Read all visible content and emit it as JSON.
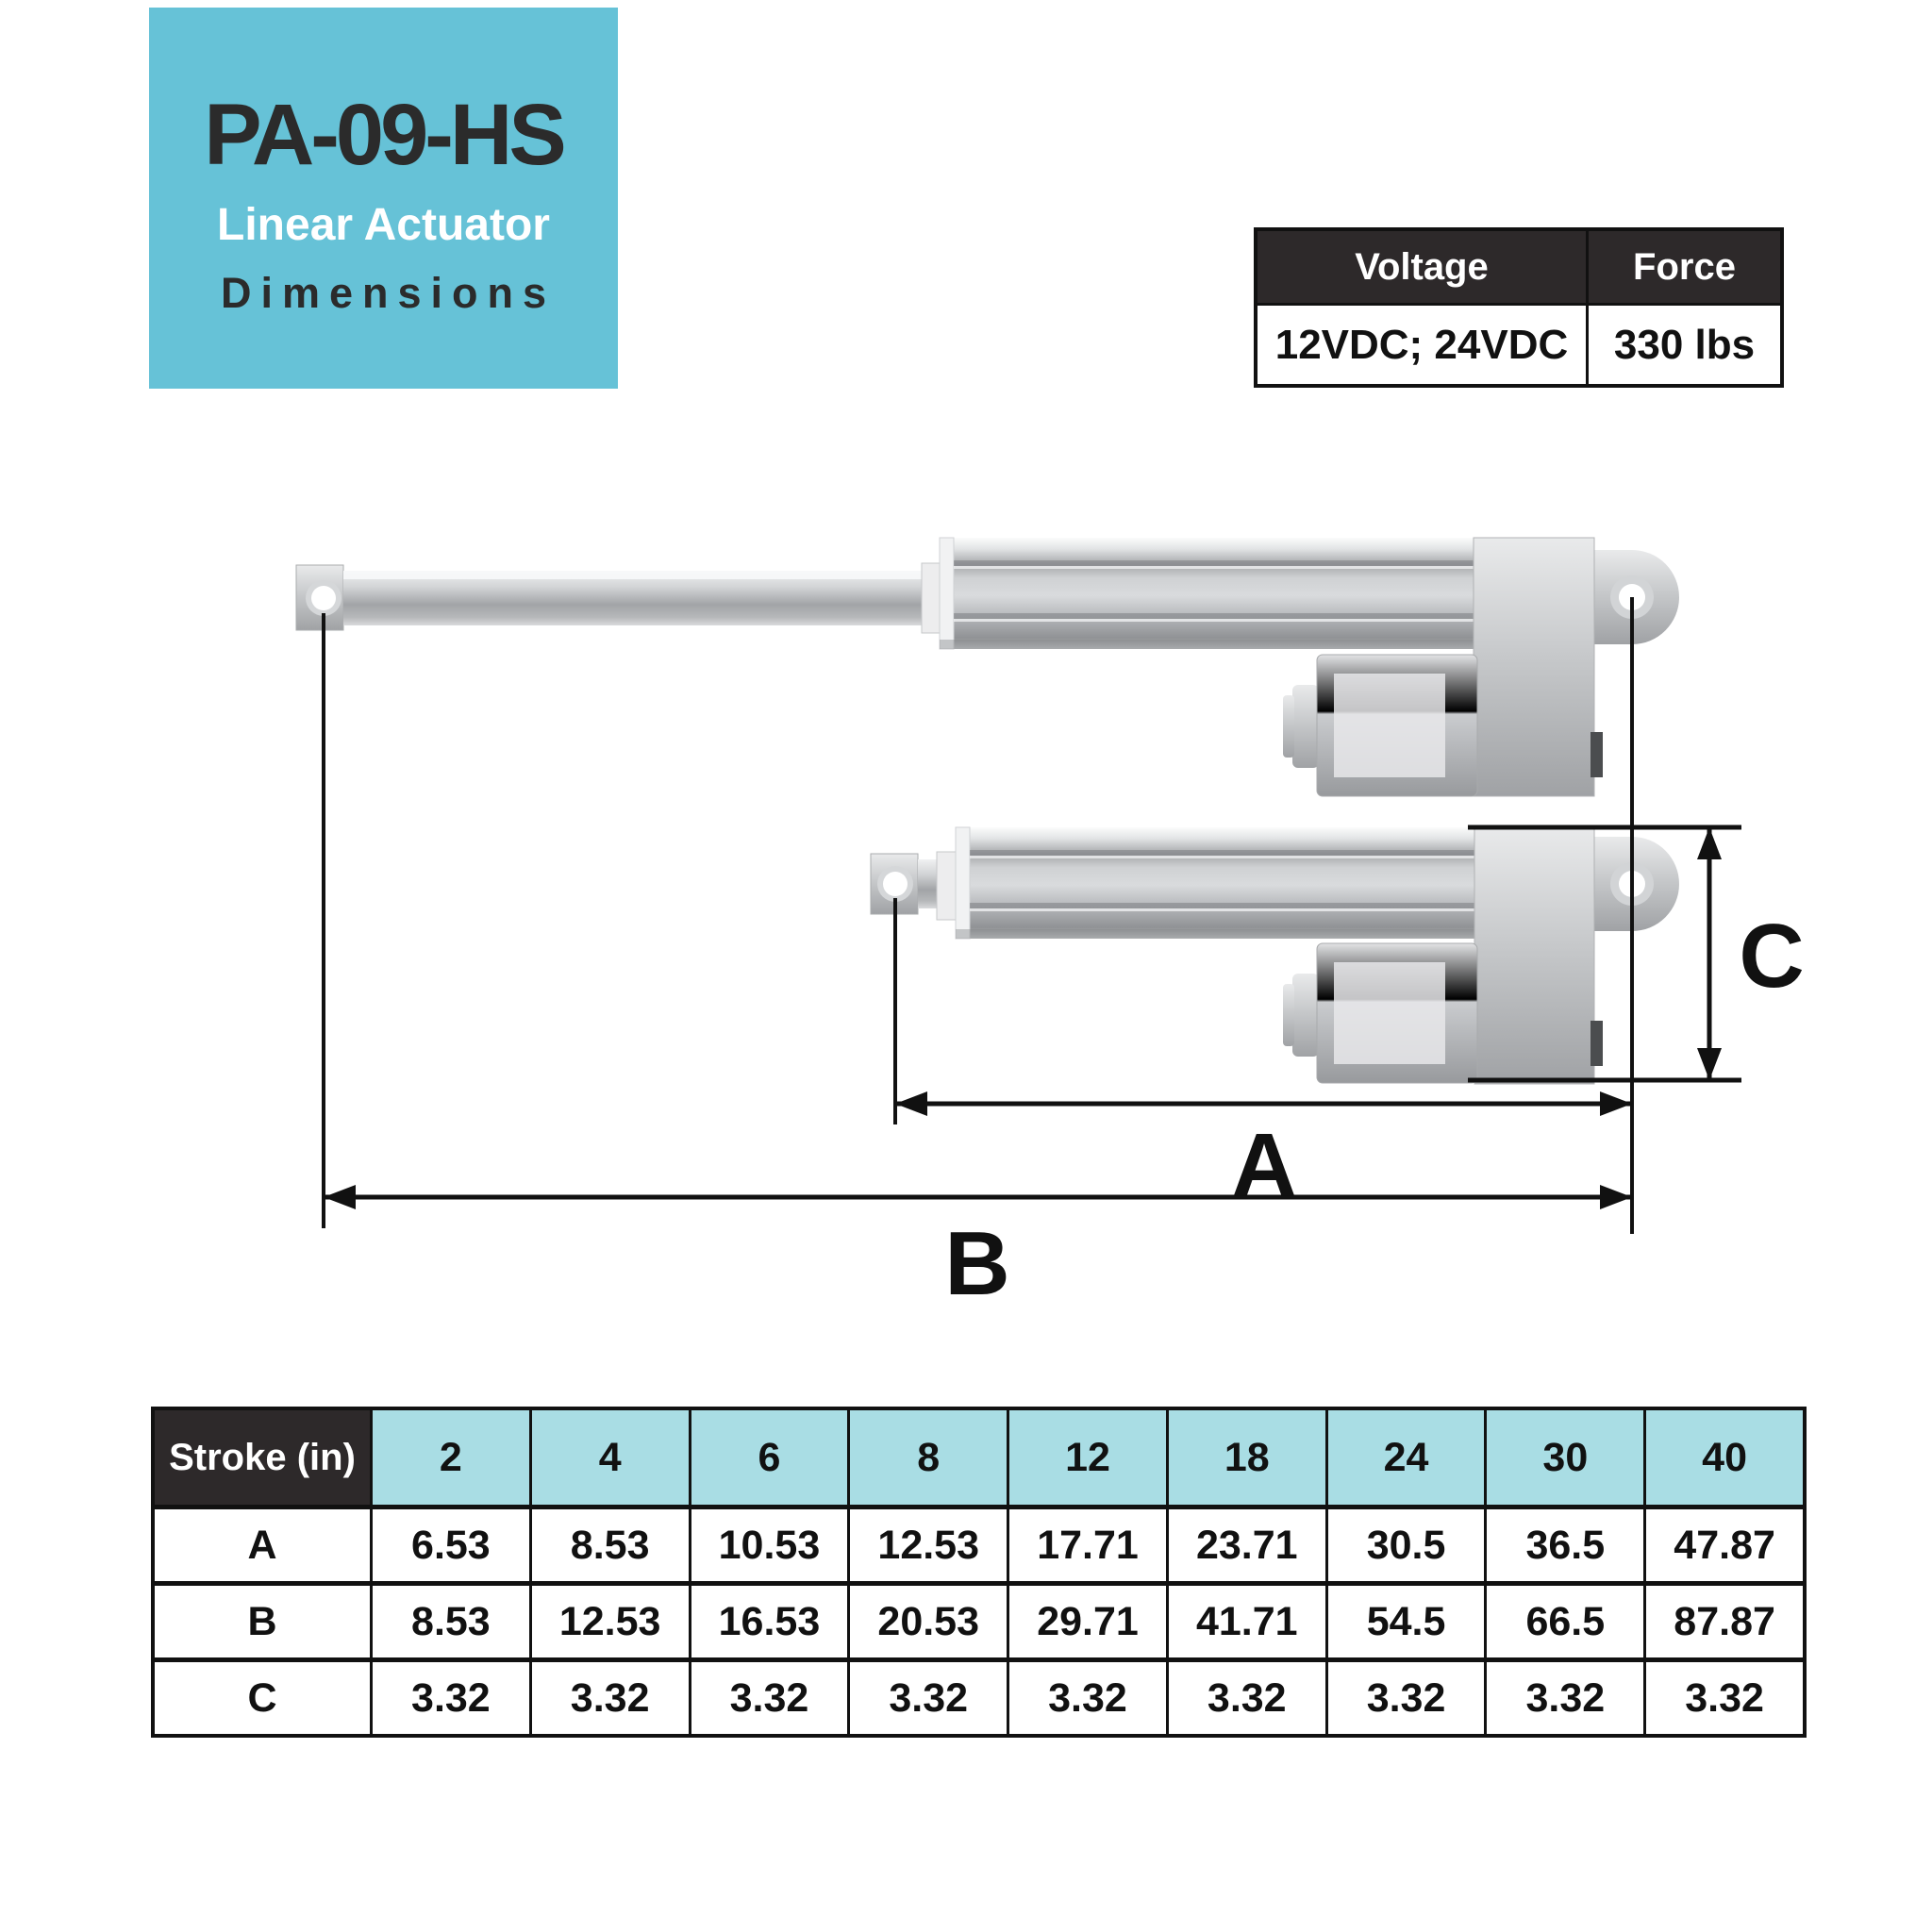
{
  "title_card": {
    "model": "PA-09-HS",
    "subtitle1": "Linear Actuator",
    "subtitle2": "Dimensions"
  },
  "spec_table": {
    "headers": [
      "Voltage",
      "Force"
    ],
    "values": [
      "12VDC; 24VDC",
      "330 lbs"
    ]
  },
  "diagram": {
    "labels": {
      "a": "A",
      "b": "B",
      "c": "C"
    }
  },
  "stroke_table": {
    "corner_label": "Stroke (in)",
    "stroke_values": [
      "2",
      "4",
      "6",
      "8",
      "12",
      "18",
      "24",
      "30",
      "40"
    ],
    "rows": [
      {
        "label": "A",
        "values": [
          "6.53",
          "8.53",
          "10.53",
          "12.53",
          "17.71",
          "23.71",
          "30.5",
          "36.5",
          "47.87"
        ]
      },
      {
        "label": "B",
        "values": [
          "8.53",
          "12.53",
          "16.53",
          "20.53",
          "29.71",
          "41.71",
          "54.5",
          "66.5",
          "87.87"
        ]
      },
      {
        "label": "C",
        "values": [
          "3.32",
          "3.32",
          "3.32",
          "3.32",
          "3.32",
          "3.32",
          "3.32",
          "3.32",
          "3.32"
        ]
      }
    ]
  },
  "colors": {
    "accent_teal": "#66c2d7",
    "header_teal": "#a9dde4",
    "dark_header": "#2d292a",
    "line_color": "#111111"
  }
}
